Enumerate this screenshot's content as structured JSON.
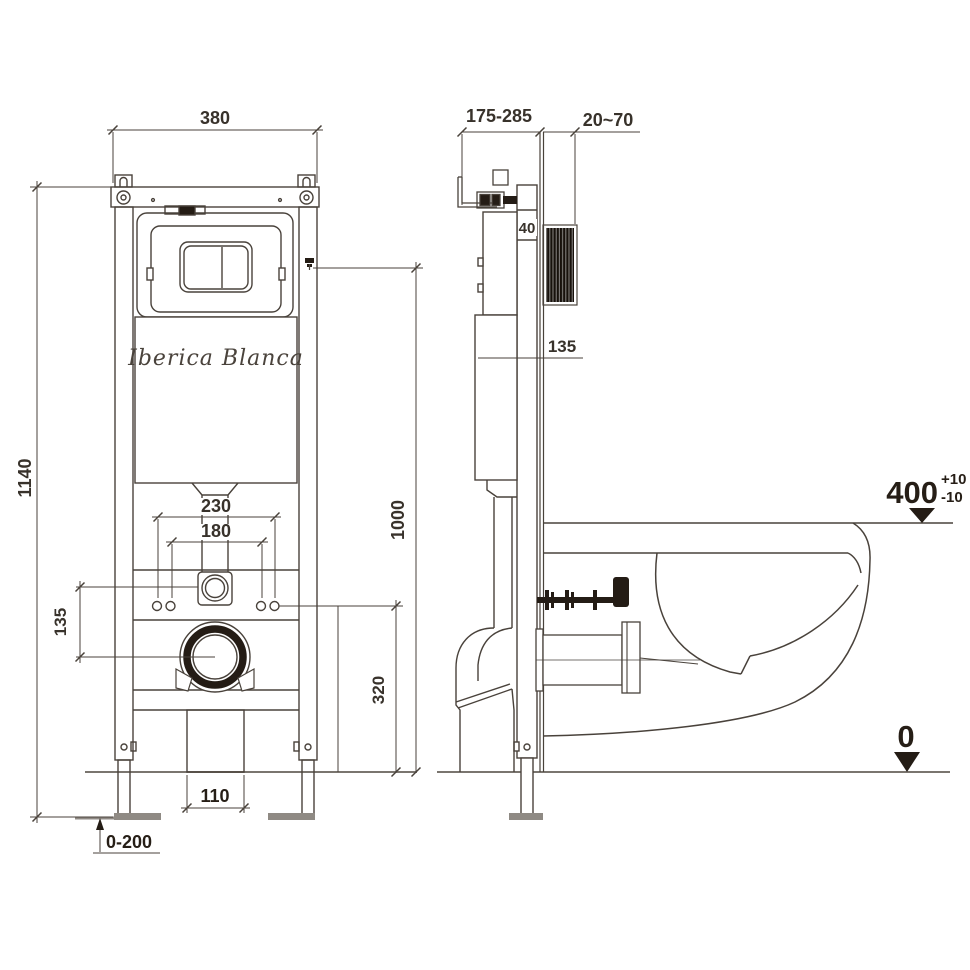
{
  "drawing": {
    "brand": "Iberica Blanca",
    "front": {
      "width": "380",
      "height": "1140",
      "bolt_span_outer": "230",
      "bolt_span_inner": "180",
      "inlet_to_drain": "135",
      "bolt_height": "320",
      "outlet_width": "110",
      "foot_adjust": "0-200",
      "flush_height": "1000"
    },
    "side": {
      "depth_adjust": "175-285",
      "wall_finish": "20~70",
      "rail_depth": "40",
      "tank_mark": "135",
      "seat_height": "400",
      "seat_tol_plus": "+10",
      "seat_tol_minus": "-10",
      "floor_level": "0"
    },
    "colors": {
      "line": "#49423b",
      "dark": "#241c15",
      "gray": "#8f8a84",
      "floor": "#7a756f"
    }
  }
}
